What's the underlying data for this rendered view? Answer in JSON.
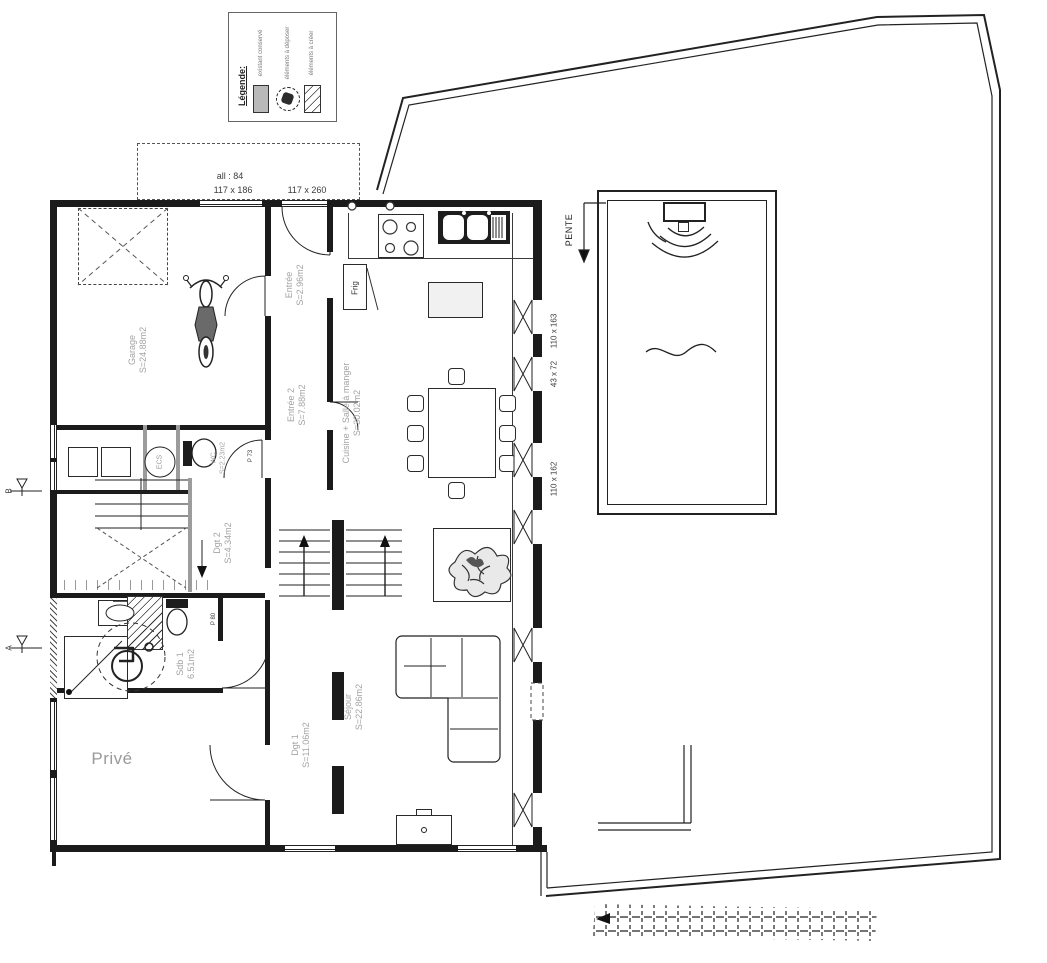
{
  "legend": {
    "title": "Légende:",
    "items": [
      {
        "label": "existant conservé",
        "symbol": "gray-rect"
      },
      {
        "label": "éléments à déposer",
        "symbol": "dashed-circle"
      },
      {
        "label": "éléments à créer",
        "symbol": "hatched-rect"
      }
    ]
  },
  "openings": {
    "attic": "all : 84",
    "door_1": "117 x 186",
    "door_2": "117 x 260",
    "window_1": "110 x 163",
    "window_2": "43 x 72",
    "window_3": "110 x 162",
    "door_ref_1": "P 73",
    "door_ref_2": "P 80"
  },
  "labels": {
    "slope": "PENTE",
    "private": "Privé",
    "fridge": "Frig",
    "water_heater": "ECS",
    "section_a": "A",
    "section_b": "B"
  },
  "rooms": [
    {
      "name": "Garage",
      "area": "S=24.88m2"
    },
    {
      "name": "Entrée",
      "area": "S=2.96m2"
    },
    {
      "name": "Entrée 2",
      "area": "S=7.88m2"
    },
    {
      "name": "Cuisine + Salle à manger",
      "area": "S=30.02m2"
    },
    {
      "name": "WC",
      "area": "S=2.23m2"
    },
    {
      "name": "Dgt 2",
      "area": "S=4.34m2"
    },
    {
      "name": "Sdb 1",
      "area": "6.51m2"
    },
    {
      "name": "Dgt 1",
      "area": "S=11.06m2"
    },
    {
      "name": "Séjour",
      "area": "S=22.86m2"
    }
  ]
}
